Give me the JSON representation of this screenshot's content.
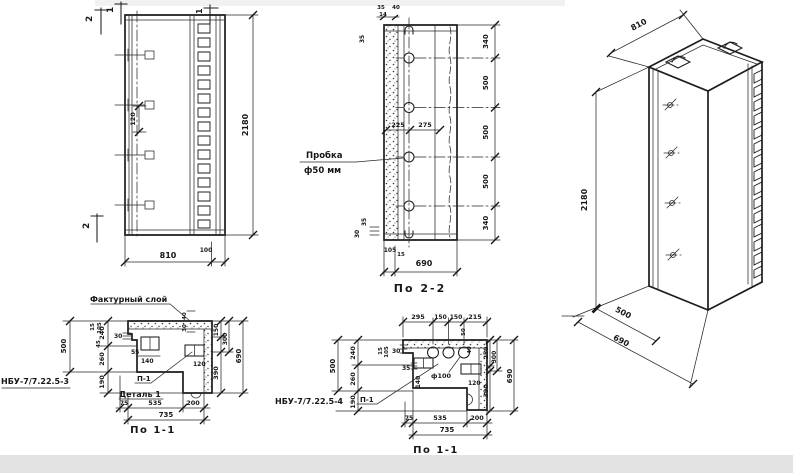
{
  "sheet": {
    "bg": "#ffffff",
    "ink": "#1c1c1c"
  },
  "elevation": {
    "mark_2_top": "2",
    "mark_1_top": "1",
    "mark_1_right": "1",
    "mark_2_bottom": "2",
    "dim_120": "120",
    "dim_2180": "2180",
    "dim_810": "810",
    "dim_100": "100"
  },
  "section22": {
    "title": "По 2-2",
    "plug_line1": "Пробка",
    "plug_line2": "ф50 мм",
    "t35": "35",
    "t14": "14",
    "t40": "40",
    "l35": "35",
    "r1": "340",
    "r2": "500",
    "r3": "500",
    "r4": "500",
    "r5": "340",
    "d225": "225",
    "d275": "275",
    "b35": "35",
    "b30": "30",
    "b105": "105",
    "b15": "15",
    "b690": "690"
  },
  "axon": {
    "d810": "810",
    "d2180": "2180",
    "d500": "500",
    "d690": "690"
  },
  "detail3": {
    "mark": "НБУ-7/7.22.5-3",
    "title": "По 1-1",
    "texture": "Фактурный слой",
    "p1": "П-1",
    "detail": "Деталь 1",
    "l500": "500",
    "l240": "240",
    "l260": "260",
    "l190": "190",
    "s15": "15",
    "s105": "105",
    "s45": "45",
    "s30": "30",
    "s55": "55",
    "s140": "140",
    "s120": "120",
    "tr40": "40",
    "tr30": "30",
    "r150": "150",
    "r300": "300",
    "r390": "390",
    "r690": "690",
    "b75": "75",
    "b535": "535",
    "b200": "200",
    "b735": "735"
  },
  "detail4": {
    "mark": "НБУ-7/7.22.5-4",
    "title": "По 1-1",
    "p1": "П-1",
    "hole": "ф100",
    "t295": "295",
    "t150a": "150",
    "t150b": "150",
    "t215": "215",
    "l500": "500",
    "l240": "240",
    "l260": "260",
    "l190": "190",
    "s15": "15",
    "s105": "105",
    "s30": "30",
    "s35": "35",
    "s50": "50",
    "s40": "40",
    "s140": "140",
    "s120": "120",
    "r250": "250",
    "r300": "300",
    "r390": "390",
    "r690": "690",
    "b75": "75",
    "b535": "535",
    "b200": "200",
    "b735": "735"
  }
}
